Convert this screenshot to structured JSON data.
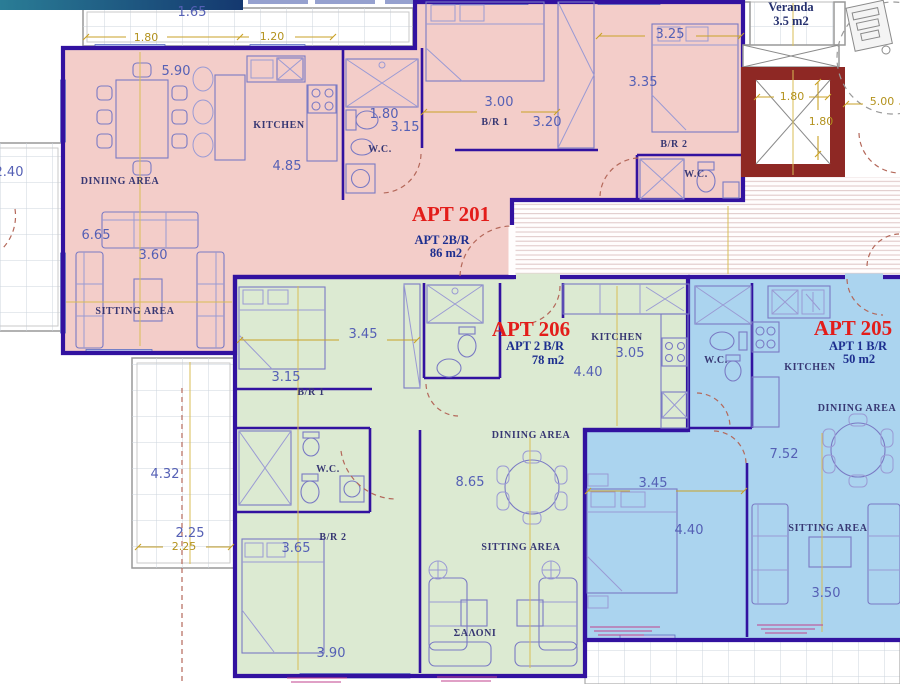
{
  "plan": {
    "colors": {
      "apt201_fill": "#f3cdc9",
      "apt206_fill": "#dcead2",
      "apt205_fill": "#abd4ef",
      "elevator_wall": "#8e2824",
      "wall": "#3212a0",
      "label_red": "#e31d1a",
      "dim_blue": "#5560b5",
      "dim_yellow": "#b3921d"
    },
    "apartments": [
      {
        "id": "201",
        "name": "APT 201",
        "type": "APT 2B/R",
        "area": "86  m2",
        "name_xy": [
          451,
          221
        ],
        "type_xy": [
          442,
          244
        ],
        "area_xy": [
          446,
          257
        ]
      },
      {
        "id": "206",
        "name": "APT 206",
        "type": "APT 2 B/R",
        "area": "78 m2",
        "name_xy": [
          531,
          336
        ],
        "type_xy": [
          535,
          350
        ],
        "area_xy": [
          548,
          364
        ]
      },
      {
        "id": "205",
        "name": "APT 205",
        "type": "APT 1 B/R",
        "area": "50 m2",
        "name_xy": [
          853,
          335
        ],
        "type_xy": [
          858,
          350
        ],
        "area_xy": [
          859,
          363
        ]
      }
    ],
    "veranda_label": {
      "line1": "Veranda",
      "line2": "3.5  m2"
    },
    "room_labels": [
      {
        "t": "KITCHEN",
        "x": 279,
        "y": 128
      },
      {
        "t": "DINIING AREA",
        "x": 120,
        "y": 184
      },
      {
        "t": "SITTING AREA",
        "x": 135,
        "y": 314
      },
      {
        "t": "B/R 1",
        "x": 495,
        "y": 125
      },
      {
        "t": "B/R 2",
        "x": 674,
        "y": 147
      },
      {
        "t": "W.C.",
        "x": 380,
        "y": 152
      },
      {
        "t": "W.C.",
        "x": 696,
        "y": 177
      },
      {
        "t": "B/R 1",
        "x": 311,
        "y": 395
      },
      {
        "t": "B/R 2",
        "x": 333,
        "y": 540
      },
      {
        "t": "W.C.",
        "x": 328,
        "y": 472
      },
      {
        "t": "KITCHEN",
        "x": 617,
        "y": 340
      },
      {
        "t": "DINIING AREA",
        "x": 531,
        "y": 438
      },
      {
        "t": "SITTING AREA",
        "x": 521,
        "y": 550
      },
      {
        "t": "ΣΑΛΟΝΙ",
        "x": 475,
        "y": 636
      },
      {
        "t": "W.C.",
        "x": 716,
        "y": 363
      },
      {
        "t": "KITCHEN",
        "x": 810,
        "y": 370
      },
      {
        "t": "DINIING AREA",
        "x": 857,
        "y": 411
      },
      {
        "t": "SITTING AREA",
        "x": 828,
        "y": 531
      }
    ],
    "dims_blue": [
      {
        "t": "1.65",
        "x": 192,
        "y": 16
      },
      {
        "t": "2.40",
        "x": 9,
        "y": 176
      },
      {
        "t": "5.90",
        "x": 176,
        "y": 75
      },
      {
        "t": "4.85",
        "x": 287,
        "y": 170
      },
      {
        "t": "1.80",
        "x": 384,
        "y": 118
      },
      {
        "t": "3.15",
        "x": 405,
        "y": 131
      },
      {
        "t": "3.00",
        "x": 499,
        "y": 106
      },
      {
        "t": "3.20",
        "x": 547,
        "y": 126
      },
      {
        "t": "3.25",
        "x": 670,
        "y": 38
      },
      {
        "t": "3.35",
        "x": 643,
        "y": 86
      },
      {
        "t": "6.65",
        "x": 96,
        "y": 239
      },
      {
        "t": "3.60",
        "x": 153,
        "y": 259
      },
      {
        "t": "4.32",
        "x": 165,
        "y": 478
      },
      {
        "t": "2.25",
        "x": 190,
        "y": 537
      },
      {
        "t": "3.45",
        "x": 363,
        "y": 338
      },
      {
        "t": "3.15",
        "x": 286,
        "y": 381
      },
      {
        "t": "3.05",
        "x": 630,
        "y": 357
      },
      {
        "t": "4.40",
        "x": 588,
        "y": 376
      },
      {
        "t": "8.65",
        "x": 470,
        "y": 486
      },
      {
        "t": "3.65",
        "x": 296,
        "y": 552
      },
      {
        "t": "3.90",
        "x": 331,
        "y": 657
      },
      {
        "t": "3.45",
        "x": 653,
        "y": 487
      },
      {
        "t": "4.40",
        "x": 689,
        "y": 534
      },
      {
        "t": "3.50",
        "x": 826,
        "y": 597
      },
      {
        "t": "7.52",
        "x": 784,
        "y": 458
      }
    ],
    "dims_yellow": [
      {
        "t": "1.80",
        "x": 146,
        "y": 41
      },
      {
        "t": "1.20",
        "x": 272,
        "y": 40
      },
      {
        "t": "1.80",
        "x": 792,
        "y": 100
      },
      {
        "t": "1.80",
        "x": 821,
        "y": 125
      },
      {
        "t": "5.00",
        "x": 882,
        "y": 105
      },
      {
        "t": "2.25",
        "x": 184,
        "y": 550
      }
    ]
  }
}
